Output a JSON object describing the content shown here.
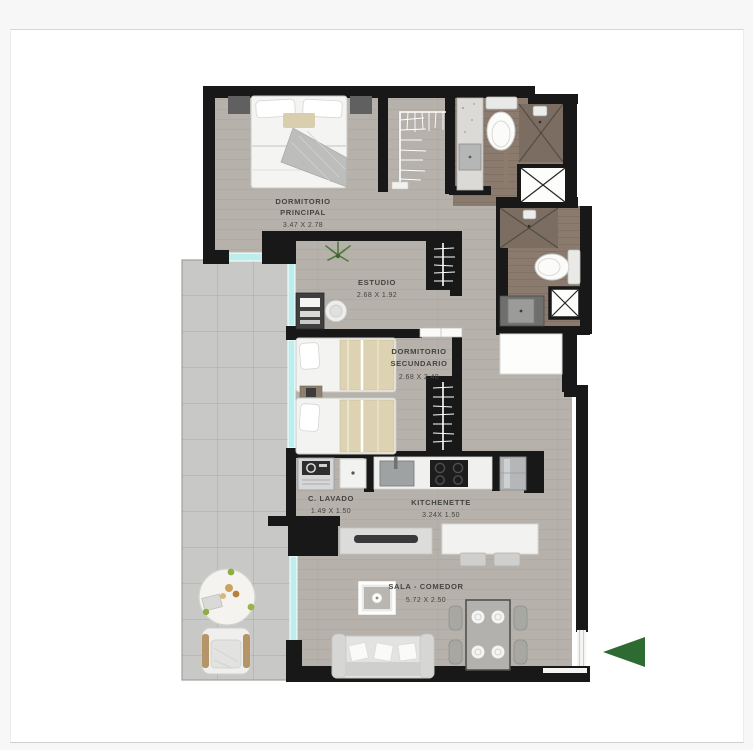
{
  "colors": {
    "pagebg": "#f7f7f7",
    "wall": "#181818",
    "wood": "#b6b1ab",
    "bath": "#8a7b6e",
    "terrace": "#c8c8c6",
    "glass": "#bdeeee",
    "label": "#45453f",
    "arrow": "#2d6b33"
  },
  "plan": {
    "type": "apartment-floor-plan",
    "rooms": [
      {
        "id": "dormitorio-principal",
        "name_line1": "DORMITORIO",
        "name_line2": "PRINCIPAL",
        "dims": "3.47 X 2.78"
      },
      {
        "id": "estudio",
        "name_line1": "ESTUDIO",
        "name_line2": "",
        "dims": "2.68 X 1.92"
      },
      {
        "id": "dormitorio-secundario",
        "name_line1": "DORMITORIO",
        "name_line2": "SECUNDARIO",
        "dims": "2.68 X 2.40"
      },
      {
        "id": "c-lavado",
        "name_line1": "C. LAVADO",
        "name_line2": "",
        "dims": "1.49 X 1.50"
      },
      {
        "id": "kitchenette",
        "name_line1": "KITCHENETTE",
        "name_line2": "",
        "dims": "3.24X 1.50"
      },
      {
        "id": "sala-comedor",
        "name_line1": "SALA - COMEDOR",
        "name_line2": "",
        "dims": "5.72 X 2.50"
      }
    ]
  }
}
